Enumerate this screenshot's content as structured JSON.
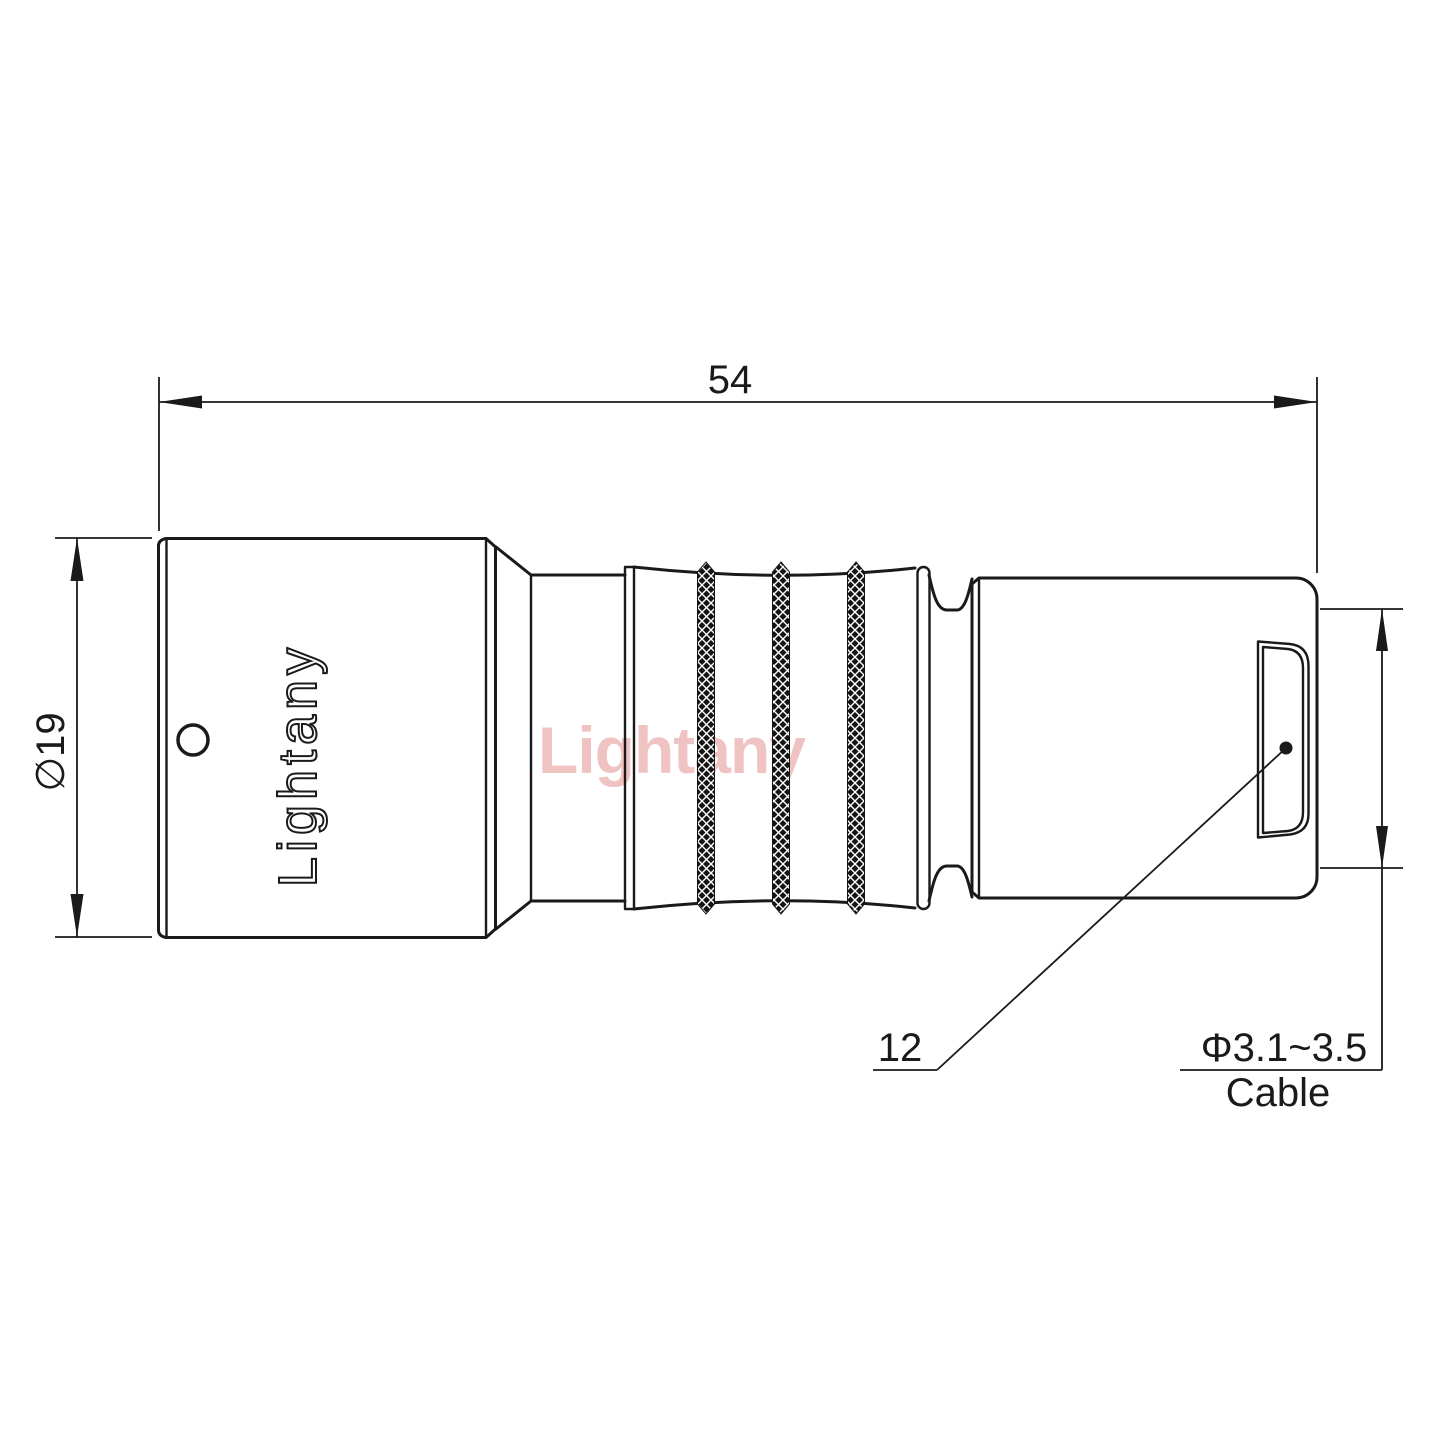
{
  "drawing_title": "push-pull-connector-side-view",
  "dimensions": {
    "overall_length": "54",
    "front_diameter": "∅19",
    "rear_diameter": "12",
    "cable_range": "Φ3.1~3.5",
    "cable_label": "Cable"
  },
  "branding": {
    "body_marking": "Lightany",
    "watermark": "Lightany"
  },
  "colors": {
    "line": "#1a1a1a",
    "watermark_pink": "#f0c3c3",
    "background": "#ffffff"
  }
}
